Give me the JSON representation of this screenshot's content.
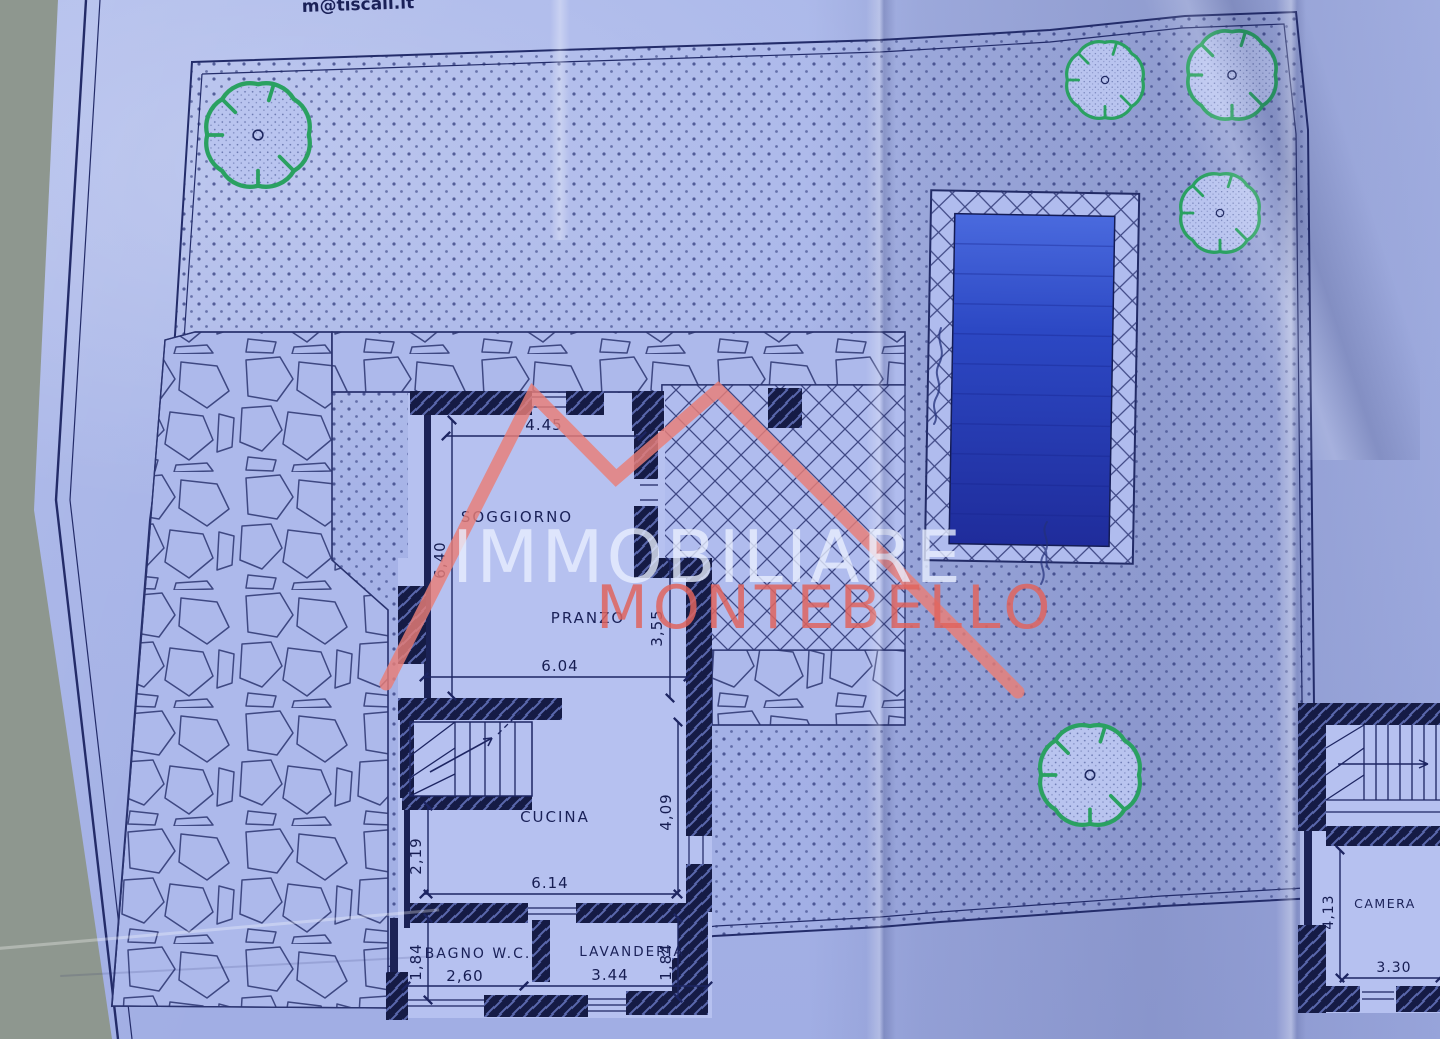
{
  "photo": {
    "email_fragment": "m@tiscali.it",
    "watermark": {
      "line1": "IMMOBILIARE",
      "line2": "MONTEBELLO"
    },
    "rooms": {
      "soggiorno": "SOGGIORNO",
      "pranzo": "PRANZO",
      "cucina": "CUCINA",
      "bagno_wc": "BAGNO W.C.",
      "lavanderia": "LAVANDERIA",
      "camera": "CAMERA"
    },
    "dimensions": {
      "soggiorno_width": "4.45",
      "soggiorno_depth": "6,40",
      "pranzo_depth": "3,55",
      "cucina_width_top": "6.04",
      "stair_width": "2,19",
      "cucina_depth": "4,09",
      "cucina_width_bottom": "6.14",
      "bagno_depth": "1,84",
      "bagno_width": "2,60",
      "lavanderia_width": "3.44",
      "lavanderia_depth": "1,84",
      "camera_depth": "4,13",
      "camera_width": "3.30"
    },
    "icons": {
      "trees": "tree-canopy-icon",
      "stairs": "staircase-icon",
      "pool": "swimming-pool",
      "handwriting": "handwritten-scribble"
    },
    "colors": {
      "paper_blue": "#a9b6e9",
      "ink_navy": "#1d2562",
      "wall_dark": "#151b45",
      "pool_light": "#4566d8",
      "pool_dark": "#1f2c9b",
      "tree_green": "#2aa161",
      "watermark_white": "#e9efff",
      "watermark_red": "#df7069",
      "table_background": "#8e978f"
    }
  }
}
